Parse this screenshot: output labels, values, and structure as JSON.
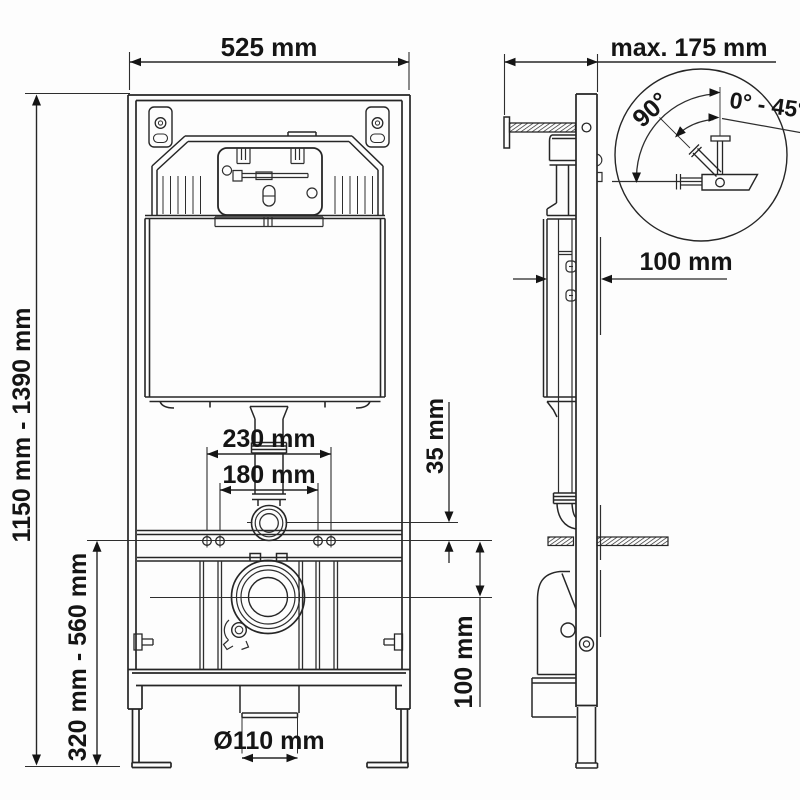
{
  "dimensions": {
    "front_width": "525 mm",
    "overall_height_range": "1150 mm - 1390 mm",
    "bowl_mount_height_range": "320 mm - 560 mm",
    "stud_spacing_outer": "230 mm",
    "stud_spacing_inner": "180 mm",
    "supply_offset": "35 mm",
    "outlet_drop": "100 mm",
    "drain_diameter": "Ø110 mm",
    "wall_offset_max": "max. 175 mm",
    "frame_depth": "100 mm"
  },
  "detail": {
    "swing_angle": "90°",
    "tilt_range": "0° - 45°"
  }
}
